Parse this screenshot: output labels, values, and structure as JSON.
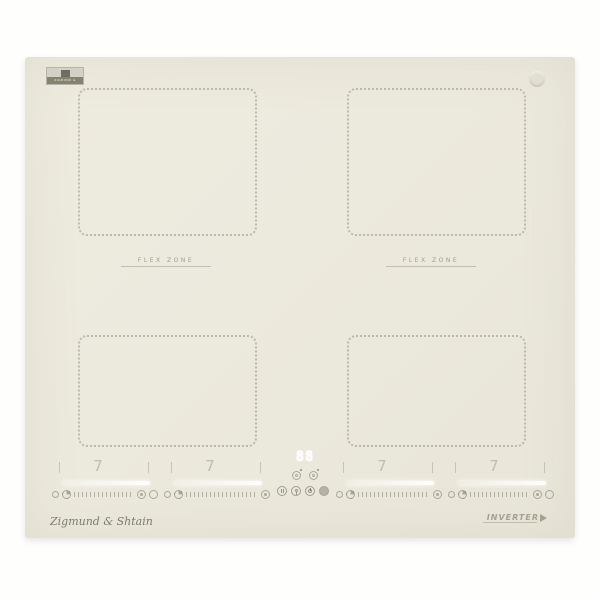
{
  "scene": {
    "background_color": "#fefefd"
  },
  "hob": {
    "surface_color": "#ece9dd",
    "logo_badge_text": "ZIGMUND & SHTAIN",
    "flex_zone_left_label": "FLEX ZONE",
    "flex_zone_right_label": "FLEX ZONE",
    "display_value": "88",
    "zone_levels": [
      "7",
      "7",
      "7",
      "7"
    ],
    "brand_script": "Zigmund & Shtain",
    "inverter_label": "INVERTER",
    "colors": {
      "dotted_zone_border": "#96938a",
      "muted_text": "#a09d8d",
      "display_white": "#ffffff"
    }
  }
}
